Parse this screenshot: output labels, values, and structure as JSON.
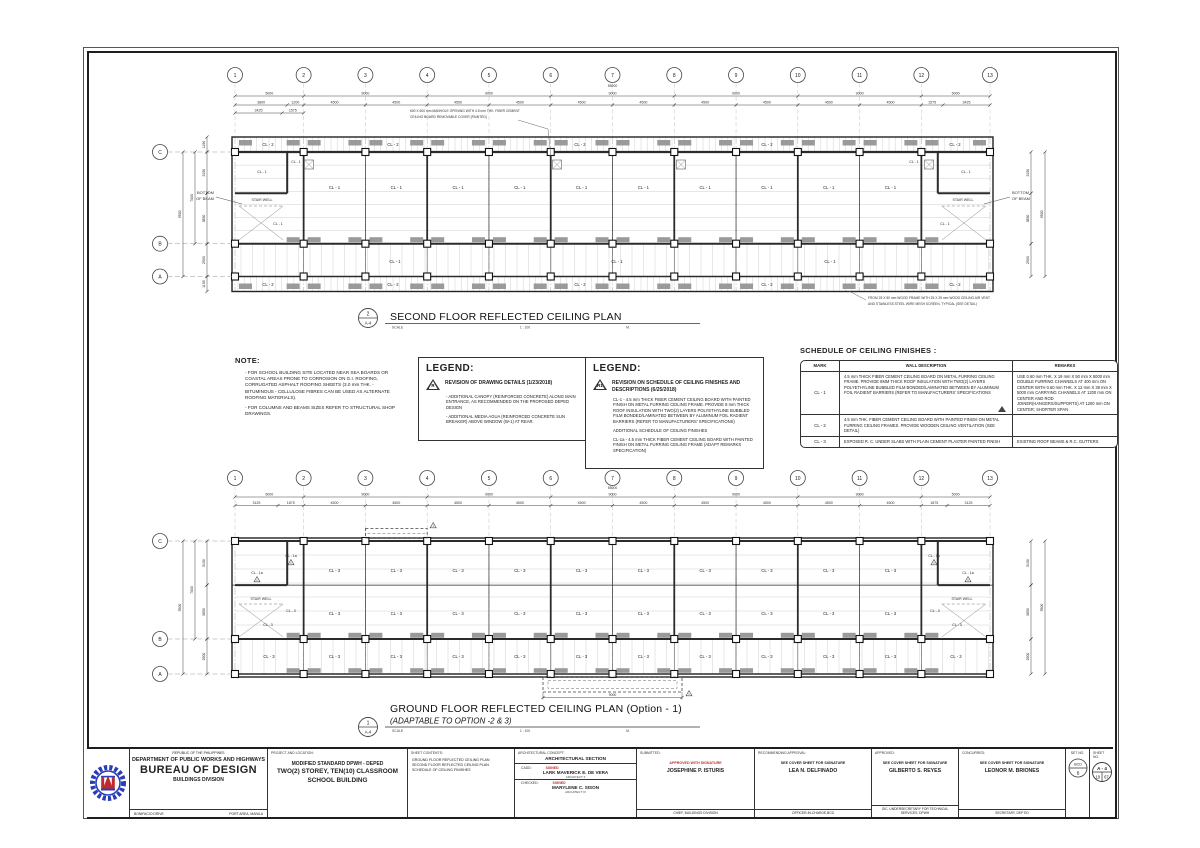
{
  "colors": {
    "line": "#2b2b2b",
    "gray_hatch": "#9a9a9a",
    "red": "#c2292c",
    "blue": "#2a3db8"
  },
  "note": {
    "title": "NOTE:",
    "items": [
      "-  FOR SCHOOL BUILDING SITE LOCATED NEAR SEA BOARDS OR COASTAL AREAS PRONE TO CORROSION ON G.I. ROOFING, CORRUGATED ASPHALT ROOFING SHEETS (3.0 mm THK. - BITUMINOUS - CELLULOSE FIBRES CAN BE USED AS ALTERNATE ROOFING MATERIALS).",
      "-  FOR COLUMNS AND BEAMS SIZES REFER TO STRUCTURAL SHOP DRAWINGS."
    ]
  },
  "legend1": {
    "title": "LEGEND:",
    "symbol": "R",
    "heading": "REVISION OF DRAWING DETAILS (1/23/2018)",
    "items": [
      "- ADDITIONAL CANOPY (REINFORCED CONCRETE) ALONG MAIN ENTRANCE, AS RECOMMENDED ON THE PROPOSED DEPED DESIGN",
      "- ADDITIONAL MEDIA AGUA (REINFORCED CONCRETE SUN BREAKER) ABOVE WINDOW (W-1) AT REAR."
    ]
  },
  "legend2": {
    "title": "LEGEND:",
    "symbol": "R1",
    "heading": "REVISION ON SCHEDULE OF CEILING FINISHES AND DESCRIPTIONS (6/25/2018)",
    "items": [
      "CL-1 - 4.5 mm THICK FIBER CEMENT CEILING BOARD WITH PAINTED FINISH ON METAL FURRING CEILING FRAME. PROVIDE 8 mm THICK ROOF INSULATION WITH TWO(2) LAYERS POLYETHYLINE BUBBLED FILM BONDED/LAMINATED BETWEEN BY ALUMINUM FOIL RADIENT BARRIERS (REFER TO MANUFACTURERS' SPECIFICATIONS)",
      "ADDITIONAL SCHEDULE OF CEILING FINISHES",
      "CL-1a - 4.5 mm THICK FIBER CEMENT CEILING BOARD WITH PAINTED FINISH ON METAL FURRING CEILING FRAME (ADAPT REMARKS SPECIFICATION)"
    ]
  },
  "schedule": {
    "title": "SCHEDULE OF CEILING FINISHES :",
    "headers": [
      "MARK",
      "WALL DESCRIPTION",
      "REMARKS"
    ],
    "rows": [
      {
        "mark": "CL - 1",
        "desc": "4.5 mm THICK FIBER CEMENT CEILING BOARD ON METAL FURRING CEILING FRAME. PROVIDE 8MM THICK ROOF INSULATION WITH TWO(2) LAYERS POLYETHYLINE BUBBLED FILM BONDED/LAMINATED BETWEEN BY ALUMINUM FOIL RADIENT BARRIERS (REFER TO MANUFACTURERS' SPECIFICATIONS",
        "remarks": "USE 0.60 mm THK. X 19 mm X 50 mm X 5000 mm DOUBLE FURRING CHANNELS AT 400 mm ON CENTER WITH 0.60 mm THK. X 12 mm X 38 mm  X 5000 mm CARRYING CHANNELS AT 1200 mm ON CENTER AND ROD JOINER(HANGERS/SUPPORTS) AT 1200 mm ON CENTER; SHORTER SPAN",
        "rev": true
      },
      {
        "mark": "CL - 2",
        "desc": "4.5 mm THK. FIBER CEMENT CEILING BOARD WITH PAINTED FINISH ON METAL FURRING CEILING FRAMES. PROVIDE WOODEN CEILING VENTILATION (SEE DETAIL)",
        "remarks": "",
        "rev": false
      },
      {
        "mark": "CL - 3",
        "desc": "EXPOSED R. C. UNDER SLABS WITH PLAIN CEMENT PLASTER PAINTED FINISH",
        "remarks": "EXISTING ROOF BEAMS & R.C. GUTTERS",
        "rev": false
      }
    ]
  },
  "plans": {
    "upper": {
      "bubble_num": "2",
      "bubble_sheet": "A-4",
      "title": "SECOND FLOOR REFLECTED CEILING PLAN",
      "scale_label": "SCALE",
      "scale_value": "1 : 100",
      "scale_unit": "M.",
      "grid_cols": [
        "1",
        "2",
        "3",
        "4",
        "5",
        "6",
        "7",
        "8",
        "9",
        "10",
        "11",
        "12",
        "13"
      ],
      "grid_rows": [
        "C",
        "B",
        "A"
      ],
      "dim_total": "55000",
      "dim_row1": [
        "5000",
        "9000",
        "9000",
        "9000",
        "9000",
        "9000",
        "5000"
      ],
      "dim_row2": [
        "3800",
        "1200",
        "4500",
        "4500",
        "4500",
        "4500",
        "4500",
        "4500",
        "4500",
        "4500",
        "4500",
        "4500",
        "1575",
        "3425"
      ],
      "dim_row3": [
        "3425",
        "1575"
      ],
      "dims_left": [
        "1150",
        "3150",
        "3850",
        "2500",
        "1150"
      ],
      "dim_left_mid": "7000",
      "dim_left_total": "9500",
      "dims_right": [
        "3150",
        "3850",
        "2500"
      ],
      "dim_right_total": "9500",
      "room": "CL - 1",
      "strip": "CL - 2",
      "corridor": "CL - 1",
      "stair": "STAIR WELL",
      "beam_l1": "BOTTOM",
      "beam_l2": "OF BEAM",
      "note_top_l1": "600 X 600 mm MANHOLE OPENING WITH 4.5 mm THK. FIBER CEMENT",
      "note_top_l2": "CEILING BOARD REMOVABLE COVER (PAINTED)",
      "note_bot_l1": "FROM 25 X 50 mm WOOD FRAME WITH 25 X 25 mm WOOD CEILING AIR VENT",
      "note_bot_l2": "AND STAINLESS STEEL WIRE MESH SCREEN, TYPICAL (SEE DETAIL)"
    },
    "lower": {
      "bubble_num": "1",
      "bubble_sheet": "A-4",
      "title": "GROUND FLOOR REFLECTED CEILING PLAN  (Option - 1)",
      "subtitle": "(ADAPTABLE TO OPTION -2 & 3)",
      "scale_label": "SCALE",
      "scale_value": "1 : 100",
      "scale_unit": "M.",
      "grid_cols": [
        "1",
        "2",
        "3",
        "4",
        "5",
        "6",
        "7",
        "8",
        "9",
        "10",
        "11",
        "12",
        "13"
      ],
      "grid_rows": [
        "C",
        "B",
        "A"
      ],
      "dim_total": "55000",
      "dim_row1": [
        "5000",
        "9000",
        "9000",
        "9000",
        "9000",
        "9000",
        "5000"
      ],
      "dim_row2": [
        "3125",
        "1875",
        "4500",
        "4500",
        "4500",
        "4500",
        "4500",
        "4500",
        "4500",
        "4500",
        "4500",
        "4500",
        "1875",
        "3125"
      ],
      "dims_left": [
        "3150",
        "3850",
        "2500"
      ],
      "dim_left_mid": "7000",
      "dim_left_total": "9500",
      "dims_right": [
        "3150",
        "3850",
        "2500"
      ],
      "dim_right_total": "9500",
      "room": "CL - 3",
      "corridor": "CL - 3",
      "stair": "STAIR WELL",
      "room_alt": "CL - 1a",
      "canopy_dim": "9000"
    }
  },
  "titleblock": {
    "republic": "REPUBLIC OF THE PHILIPPINES",
    "department": "DEPARTMENT OF PUBLIC WORKS AND HIGHWAYS",
    "bureau": "BUREAU OF DESIGN",
    "division": "BUILDINGS DIVISION",
    "addr_left": "BONIFACIO DRIVE",
    "addr_right": "PORT AREA, MANILA",
    "project_label": "PROJECT AND LOCATION:",
    "project_l1": "MODIFIED STANDARD DPWH - DEPED",
    "project_l2": "TWO(2) STOREY, TEN(10) CLASSROOM",
    "project_l3": "SCHOOL BUILDING",
    "contents_label": "SHEET CONTENTS:",
    "contents": [
      "GROUND FLOOR REFLECTED CEILING PLAN",
      "SECOND FLOOR REFLECTED CEILING PLAN",
      "SCHEDULE OF CEILING FINISHES"
    ],
    "arch_label": "ARCHITECTURAL CONCEPT:",
    "arch_value": "ARCHITECTURAL SECTION",
    "cadd_label": "CADD:",
    "cadd_signed": "SIGNED",
    "cadd_name": "LARK MAVERICK E. DE VERA",
    "cadd_title": "ARCHITECT II",
    "checked_label": "CHECKED:",
    "checked_signed": "SIGNED",
    "checked_name": "MARYLENE C. SISON",
    "checked_title": "ARCHITECT IV",
    "submitted_label": "SUBMITTED:",
    "submitted_note": "APPROVED WITH SIGNATURE",
    "submitted_name": "JOSEPHINE P. ISTURIS",
    "submitted_role": "CHIEF, BUILDINGS DIVISION",
    "recommending_label": "RECOMMENDING APPROVAL:",
    "recommending_note": "SEE COVER SHEET FOR SIGNATURE",
    "recommending_name": "LEA N. DELFINADO",
    "recommending_role": "OFFICER-IN-CHARGE,BCD",
    "approved_label": "APPROVED:",
    "approved_note": "SEE COVER SHEET FOR SIGNATURE",
    "approved_name": "GILBERTO S. REYES",
    "approved_role": "OIC, UNDERSECRETARY FOR TECHNICAL SERVICES, DPWH",
    "concurred_label": "CONCURRED:",
    "concurred_note": "SEE COVER SHEET FOR SIGNATURE",
    "concurred_name": "LEONOR M. BRIONES",
    "concurred_role": "SECRETARY, DEP ED",
    "set_label": "SET NO.",
    "set_top": "BCD",
    "set_bottom": "B",
    "sheet_label": "SHEET NO.",
    "sheet_top": "A - 4",
    "sheet_bl": "19",
    "sheet_br": "67"
  }
}
